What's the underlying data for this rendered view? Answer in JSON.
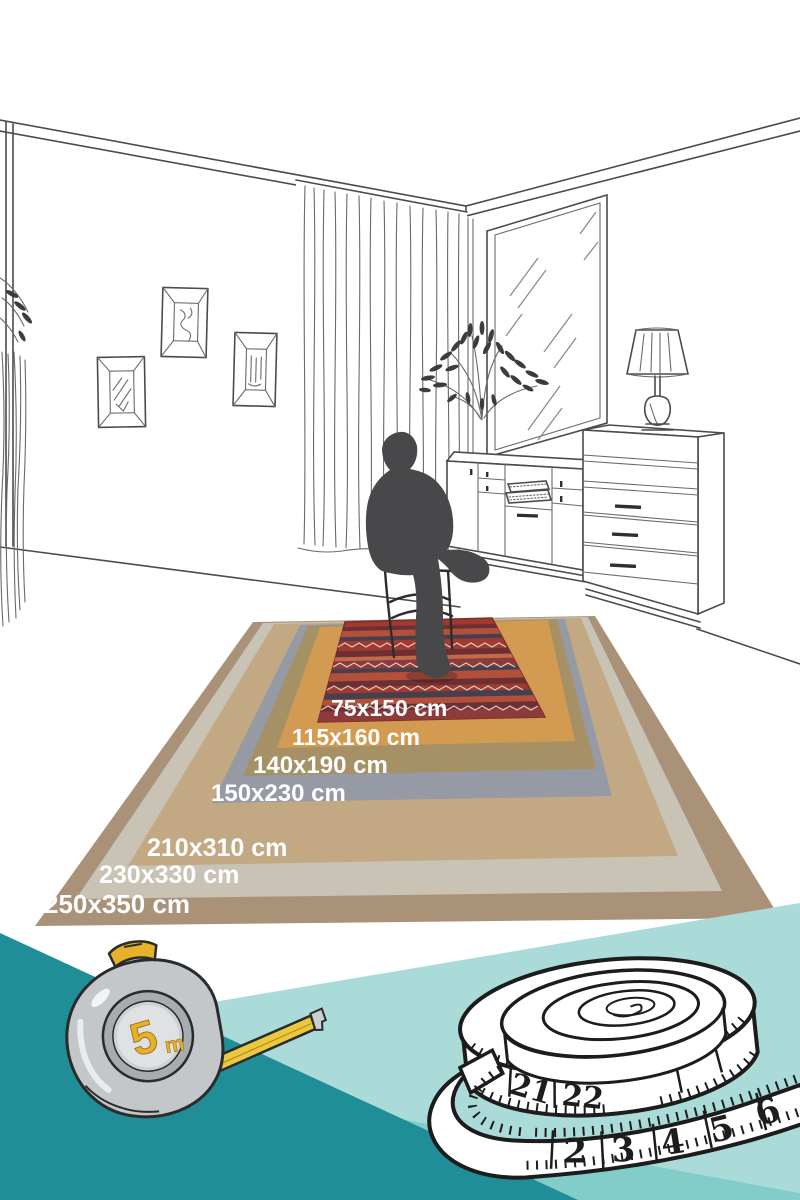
{
  "scene": {
    "description_labels": [
      "75x150 cm",
      "115x160 cm",
      "140x190 cm",
      "150x230 cm",
      "210x310 cm",
      "230x330 cm",
      "250x350 cm"
    ],
    "rugs": [
      {
        "label": "250x350 cm",
        "color": "#aa9279"
      },
      {
        "label": "230x330 cm",
        "color": "#c8c3b5"
      },
      {
        "label": "210x310 cm",
        "color": "#c3a884"
      },
      {
        "label": "150x230 cm",
        "color": "#959aa5"
      },
      {
        "label": "140x190 cm",
        "color": "#a59165"
      },
      {
        "label": "115x160 cm",
        "color": "#d39a51"
      },
      {
        "label": "75x150 cm",
        "color": "#a03a2f"
      }
    ],
    "room": {
      "line_color": "#4b4b4b",
      "silhouette_color": "#48484a"
    }
  },
  "bottom": {
    "colors": {
      "dark_teal": "#1f8e96",
      "light_teal": "#aadbd8",
      "medium_teal": "#82cdca"
    },
    "tape_measure": {
      "number": "5",
      "unit": "m",
      "accent": "#e8b12c"
    },
    "tailor_tape": {
      "numbers": [
        "21",
        "22",
        "2",
        "3",
        "4",
        "5",
        "6",
        "7"
      ]
    }
  }
}
